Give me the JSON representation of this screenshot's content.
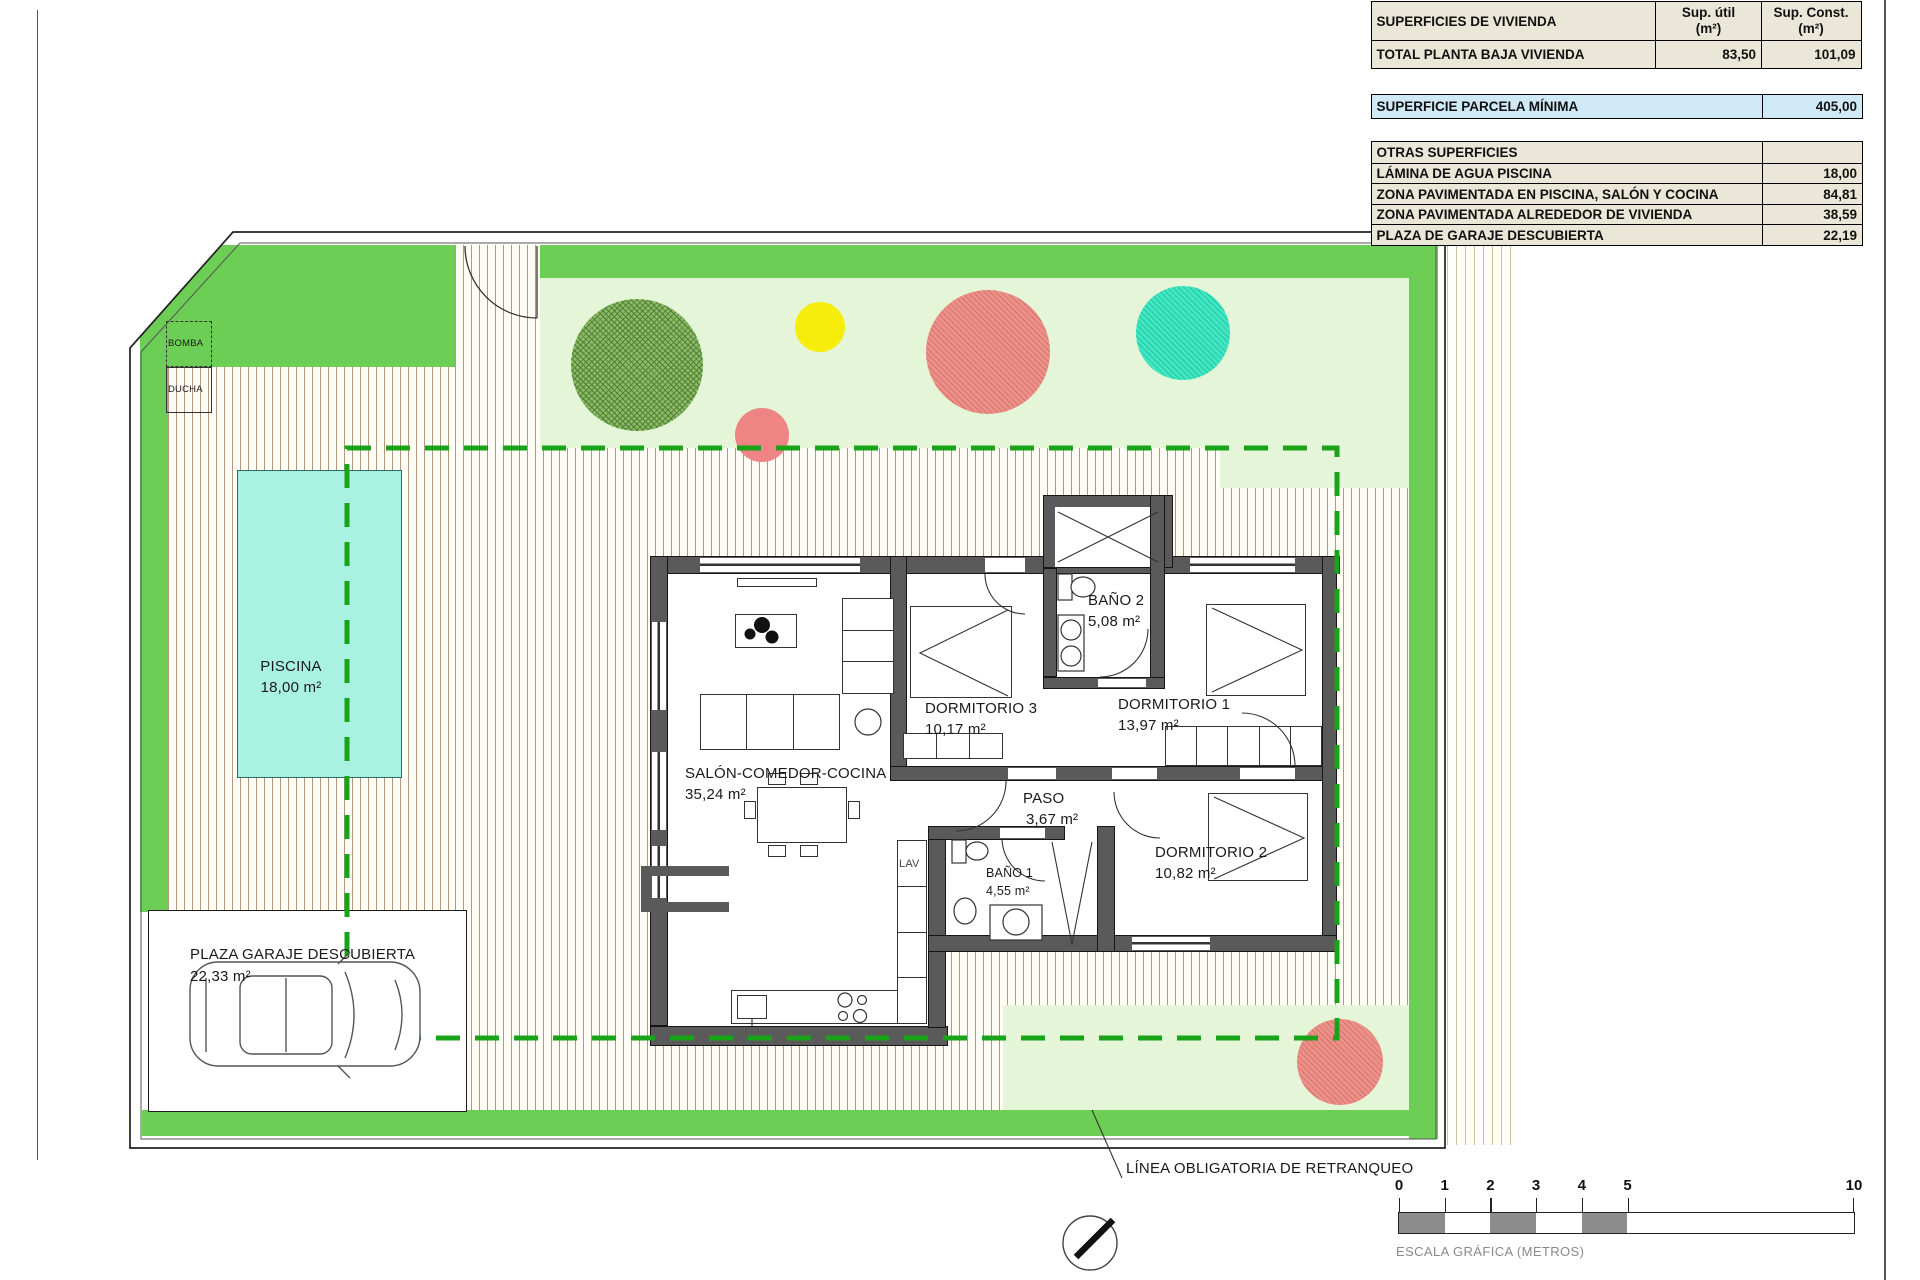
{
  "table": {
    "superficies": {
      "title": "SUPERFICIES DE VIVIENDA",
      "col_util_l1": "Sup. útil",
      "col_util_l2": "(m²)",
      "col_const_l1": "Sup. Const.",
      "col_const_l2": "(m²)",
      "total": {
        "label": "TOTAL PLANTA BAJA VIVIENDA",
        "util": "83,50",
        "const": "101,09"
      }
    },
    "parcela": {
      "label": "SUPERFICIE PARCELA MÍNIMA",
      "value": "405,00"
    },
    "otras": {
      "title": "OTRAS SUPERFICIES",
      "rows": [
        {
          "label": "LÁMINA DE AGUA PISCINA",
          "value": "18,00"
        },
        {
          "label": "ZONA PAVIMENTADA EN PISCINA, SALÓN Y COCINA",
          "value": "84,81"
        },
        {
          "label": "ZONA PAVIMENTADA ALREDEDOR DE VIVIENDA",
          "value": "38,59"
        },
        {
          "label": "PLAZA DE GARAJE DESCUBIERTA",
          "value": "22,19"
        }
      ]
    }
  },
  "rooms": {
    "salon": {
      "name": "SALÓN-COMEDOR-COCINA",
      "area": "35,24 m²"
    },
    "dormitorio3": {
      "name": "DORMITORIO 3",
      "area": "10,17 m²"
    },
    "bano2": {
      "name": "BAÑO 2",
      "area": "5,08 m²"
    },
    "dormitorio1": {
      "name": "DORMITORIO 1",
      "area": "13,97 m²"
    },
    "paso": {
      "name": "PASO",
      "area": "3,67 m²"
    },
    "bano1": {
      "name": "BAÑO 1",
      "area": "4,55 m²"
    },
    "dormitorio2": {
      "name": "DORMITORIO 2",
      "area": "10,82 m²"
    },
    "lav": {
      "name": "LAV"
    }
  },
  "site": {
    "piscina": {
      "name": "PISCINA",
      "area": "18,00 m²"
    },
    "garaje": {
      "name": "PLAZA GARAJE DESCUBIERTA",
      "area": "22,33 m²"
    },
    "bomba": "BOMBA",
    "ducha": "DUCHA",
    "retranqueo_label": "LÍNEA OBLIGATORIA DE RETRANQUEO"
  },
  "scalebar": {
    "label": "ESCALA GRÁFICA (METROS)",
    "ticks": [
      "0",
      "1",
      "2",
      "3",
      "4",
      "5",
      "10"
    ]
  },
  "colors": {
    "grass": "#6dce55",
    "garden": "#e4f6d7",
    "pool_water": "#a9f2e2",
    "setback_line": "#19a319",
    "wall": "#5a5a5a",
    "table_bg": "#eae6d8",
    "highlight_row": "#cfe9f6"
  }
}
